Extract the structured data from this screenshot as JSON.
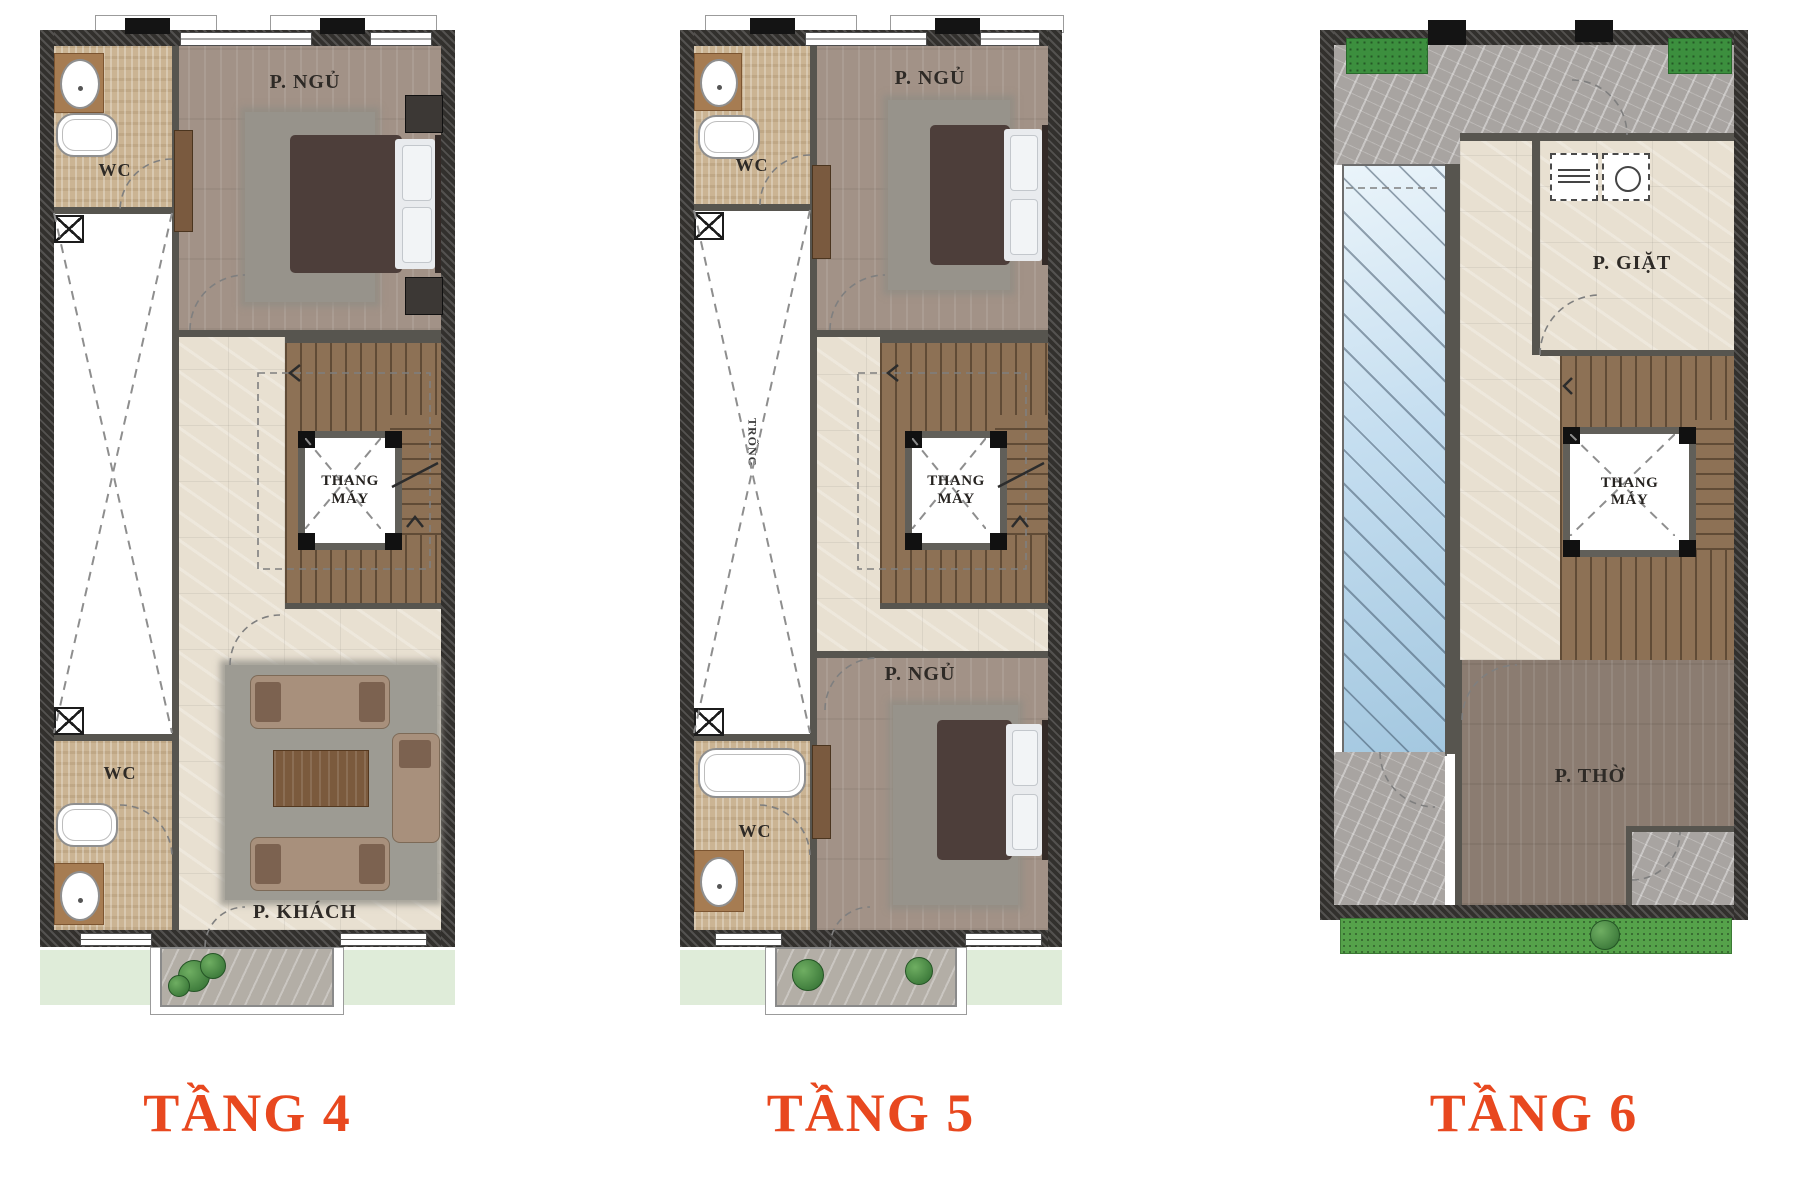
{
  "background": "#ffffff",
  "colors": {
    "caption_accent": "#e8481f",
    "wall": "#32302d",
    "wood_light": "#a29287",
    "wood_dark": "#8b7c71",
    "tile_beige": "#cbb493",
    "marble_cream": "#e8e0d1",
    "marble_grey": "#a8a4a1",
    "glass_blue": "#c5def0",
    "grass_green": "#55a24a"
  },
  "plans": [
    {
      "caption": "TẦNG 4",
      "rooms": {
        "wc_top": "WC",
        "bedroom": "P. NGỦ",
        "elevator": "THANG MÁY",
        "wc_bottom": "WC",
        "living": "P. KHÁCH"
      }
    },
    {
      "caption": "TẦNG 5",
      "rooms": {
        "wc_top": "WC",
        "bedroom_top": "P. NGỦ",
        "elevator": "THANG MÁY",
        "void": "TRỐNG",
        "bedroom_bottom": "P. NGỦ",
        "wc_bottom": "WC"
      }
    },
    {
      "caption": "TẦNG 6",
      "rooms": {
        "laundry": "P. GIẶT",
        "elevator": "THANG MÁY",
        "worship": "P. THỜ"
      }
    }
  ]
}
